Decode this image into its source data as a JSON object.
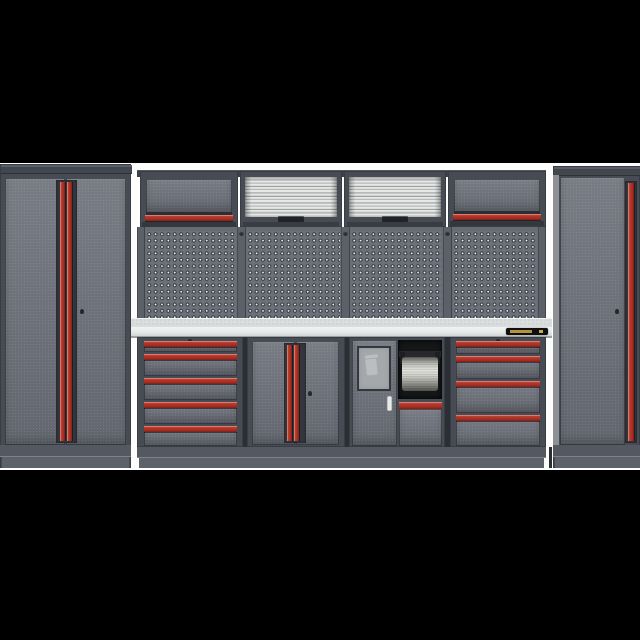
{
  "image": {
    "kind": "product-photo",
    "subject": "Modular garage workshop storage cabinet system",
    "background_color": "#fdfdfd",
    "letterbox_color": "#000000"
  },
  "palette": {
    "cabinet_gray": "#6e727b",
    "frame_dark": "#474b53",
    "handle_red": "#b4372a",
    "pegboard_gray": "#6c7078",
    "pegboard_dot_white": "#eff0ef",
    "shutter_silver": "#d6d8d7",
    "worktop_steel": "#e7e9e9",
    "brand_label_black": "#101010",
    "brand_label_gold": "#b5923f"
  },
  "components": {
    "left_locker": {
      "label": "Tall two-door locker cabinet with vertical red handles",
      "doors": 2
    },
    "wall_cabinet_left": {
      "label": "Wall cabinet with lift-up door and red handle"
    },
    "shutter_cabinet_1": {
      "label": "Roller-shutter wall cabinet"
    },
    "shutter_cabinet_2": {
      "label": "Roller-shutter wall cabinet"
    },
    "wall_cabinet_right": {
      "label": "Wall cabinet with lift-up door and red handle"
    },
    "pegboard": {
      "label": "Perforated tool pegboard back panels",
      "panels": 4
    },
    "worktop": {
      "label": "Stainless steel worktop",
      "brand_label": "illegible gold-on-black brand sticker"
    },
    "drawer_unit_5": {
      "label": "Base cabinet with five drawers",
      "drawers": 5
    },
    "door_cabinet": {
      "label": "Two-door base cabinet with vertical red handles",
      "doors": 2
    },
    "utility_cabinet": {
      "label": "Base cabinet with frosted-glass waste door, paper-towel dispenser and drawer"
    },
    "drawer_unit_4": {
      "label": "Base cabinet with four drawers",
      "drawers": 4
    },
    "right_locker": {
      "label": "Tall single-door locker cabinet with vertical red handle",
      "doors": 1
    }
  }
}
